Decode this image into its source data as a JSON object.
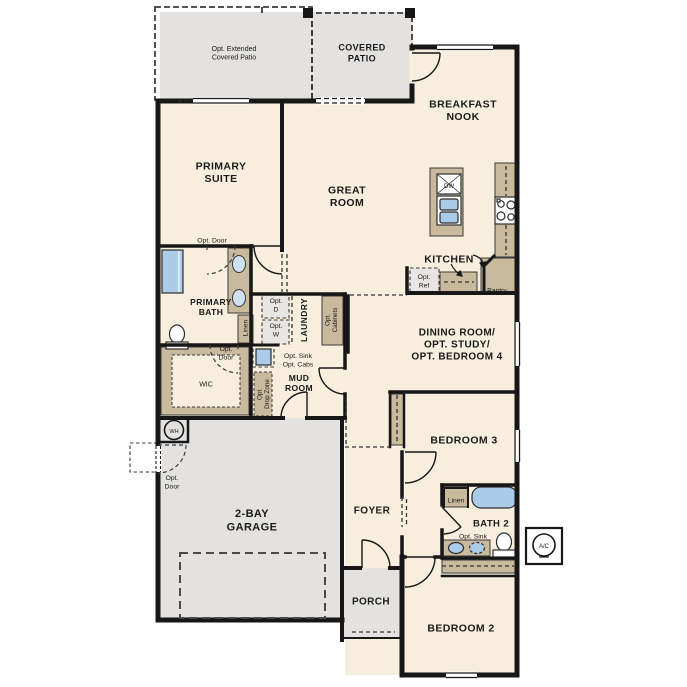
{
  "plan": {
    "name": "single-story-floor-plan",
    "colors": {
      "floor": "#f7eedd",
      "exterior_gray": "#e3e2e0",
      "cabinet_tan": "#c9b99d",
      "option_box_gray": "#e7e6e4",
      "fixture_blue": "#abcbe9",
      "fixture_blue_light": "#cfe0f2",
      "wall_black": "#171717",
      "page_bg": "#ffffff"
    },
    "rooms": [
      "Opt. Extended Covered Patio",
      "Covered Patio",
      "Breakfast Nook",
      "Primary Suite",
      "Great Room",
      "Kitchen",
      "Primary Bath",
      "WIC",
      "Laundry",
      "Mud Room",
      "Dining Room / Opt. Study / Opt. Bedroom 4",
      "Bedroom 3",
      "Bath 2",
      "2-Bay Garage",
      "Foyer",
      "Porch",
      "Bedroom 2"
    ],
    "fixtures": [
      "shower",
      "double-vanity",
      "toilet",
      "linen-cabinet",
      "washer",
      "dryer",
      "laundry-sink",
      "kitchen-island",
      "dishwasher",
      "kitchen-sink",
      "cooktop",
      "refrigerator",
      "pantry",
      "bathtub",
      "vanity-sink",
      "optional-sink",
      "water-heater",
      "ac-unit",
      "closet-rod",
      "garage-door"
    ]
  },
  "labels": [
    {
      "name": "label-opt-extended-covered-patio",
      "lines": [
        "Opt. Extended",
        "Covered Patio"
      ],
      "x": 234,
      "y": 53,
      "size": 7,
      "bold": false,
      "rot": 0
    },
    {
      "name": "label-covered-patio",
      "lines": [
        "COVERED",
        "PATIO"
      ],
      "x": 362,
      "y": 53,
      "size": 9,
      "bold": true,
      "rot": 0
    },
    {
      "name": "label-breakfast-nook",
      "lines": [
        "BREAKFAST",
        "NOOK"
      ],
      "x": 463,
      "y": 110,
      "size": 10.5,
      "bold": true,
      "rot": 0
    },
    {
      "name": "label-primary-suite",
      "lines": [
        "PRIMARY",
        "SUITE"
      ],
      "x": 221,
      "y": 172,
      "size": 10.5,
      "bold": true,
      "rot": 0
    },
    {
      "name": "label-great-room",
      "lines": [
        "GREAT",
        "ROOM"
      ],
      "x": 347,
      "y": 196,
      "size": 10.5,
      "bold": true,
      "rot": 0
    },
    {
      "name": "label-kitchen",
      "lines": [
        "KITCHEN"
      ],
      "x": 449,
      "y": 259,
      "size": 10.5,
      "bold": true,
      "rot": 0
    },
    {
      "name": "label-opt-door-suite",
      "lines": [
        "Opt. Door"
      ],
      "x": 212,
      "y": 240,
      "size": 6.8,
      "bold": false,
      "rot": 0
    },
    {
      "name": "label-primary-bath",
      "lines": [
        "PRIMARY",
        "BATH"
      ],
      "x": 211,
      "y": 307,
      "size": 8.5,
      "bold": true,
      "rot": 0
    },
    {
      "name": "label-linen-primary",
      "lines": [
        "Linen"
      ],
      "x": 245,
      "y": 328,
      "size": 6.8,
      "bold": false,
      "rot": -90
    },
    {
      "name": "label-opt-door-bath",
      "lines": [
        "Opt.",
        "Door"
      ],
      "x": 226,
      "y": 353,
      "size": 6.8,
      "bold": false,
      "rot": 0
    },
    {
      "name": "label-wic",
      "lines": [
        "WIC"
      ],
      "x": 206,
      "y": 384,
      "size": 7,
      "bold": false,
      "rot": 0
    },
    {
      "name": "label-opt-dryer",
      "lines": [
        "Opt.",
        "D"
      ],
      "x": 276,
      "y": 305,
      "size": 6.8,
      "bold": false,
      "rot": 0
    },
    {
      "name": "label-opt-washer",
      "lines": [
        "Opt.",
        "W"
      ],
      "x": 276,
      "y": 330,
      "size": 6.8,
      "bold": false,
      "rot": 0
    },
    {
      "name": "label-laundry",
      "lines": [
        "LAUNDRY"
      ],
      "x": 304,
      "y": 320,
      "size": 8.5,
      "bold": true,
      "rot": -90
    },
    {
      "name": "label-opt-cabinets",
      "lines": [
        "Opt.",
        "Cabinets"
      ],
      "x": 331,
      "y": 320,
      "size": 6.3,
      "bold": false,
      "rot": -90
    },
    {
      "name": "label-opt-sink-cabs",
      "lines": [
        "Opt. Sink",
        "Opt. Cabs"
      ],
      "x": 298,
      "y": 360,
      "size": 6.8,
      "bold": false,
      "rot": 0
    },
    {
      "name": "label-mud-room",
      "lines": [
        "MUD",
        "ROOM"
      ],
      "x": 299,
      "y": 383,
      "size": 8.5,
      "bold": true,
      "rot": 0
    },
    {
      "name": "label-opt-drop-zone",
      "lines": [
        "Opt.",
        "Drop Zone"
      ],
      "x": 263,
      "y": 394,
      "size": 6.3,
      "bold": false,
      "rot": -90
    },
    {
      "name": "label-opt-ref",
      "lines": [
        "Opt.",
        "Ref"
      ],
      "x": 424,
      "y": 281,
      "size": 6.8,
      "bold": false,
      "rot": 0
    },
    {
      "name": "label-pantry",
      "lines": [
        "Pantry"
      ],
      "x": 497,
      "y": 290,
      "size": 6.8,
      "bold": false,
      "rot": 0
    },
    {
      "name": "label-dining-room",
      "lines": [
        "DINING ROOM/",
        "OPT. STUDY/",
        "OPT. BEDROOM 4"
      ],
      "x": 457,
      "y": 344,
      "size": 10,
      "bold": true,
      "rot": 0
    },
    {
      "name": "label-bedroom-3",
      "lines": [
        "BEDROOM 3"
      ],
      "x": 464,
      "y": 440,
      "size": 10.5,
      "bold": true,
      "rot": 0
    },
    {
      "name": "label-linen-bath2",
      "lines": [
        "Linen"
      ],
      "x": 456,
      "y": 500,
      "size": 6.8,
      "bold": false,
      "rot": 0
    },
    {
      "name": "label-bath-2",
      "lines": [
        "BATH 2"
      ],
      "x": 491,
      "y": 523,
      "size": 9.5,
      "bold": true,
      "rot": 0
    },
    {
      "name": "label-opt-sink-bath2",
      "lines": [
        "Opt. Sink"
      ],
      "x": 473,
      "y": 536,
      "size": 6.8,
      "bold": false,
      "rot": 0
    },
    {
      "name": "label-water-heater",
      "lines": [
        "WH"
      ],
      "x": 174,
      "y": 431,
      "size": 5.5,
      "bold": false,
      "rot": 0
    },
    {
      "name": "label-opt-door-garage",
      "lines": [
        "Opt.",
        "Door"
      ],
      "x": 172,
      "y": 482,
      "size": 6.8,
      "bold": false,
      "rot": 0
    },
    {
      "name": "label-garage",
      "lines": [
        "2-BAY",
        "GARAGE"
      ],
      "x": 252,
      "y": 520,
      "size": 11,
      "bold": true,
      "rot": 0
    },
    {
      "name": "label-foyer",
      "lines": [
        "FOYER"
      ],
      "x": 372,
      "y": 510,
      "size": 10,
      "bold": true,
      "rot": 0
    },
    {
      "name": "label-porch",
      "lines": [
        "PORCH"
      ],
      "x": 371,
      "y": 601,
      "size": 10,
      "bold": true,
      "rot": 0
    },
    {
      "name": "label-bedroom-2",
      "lines": [
        "BEDROOM 2"
      ],
      "x": 461,
      "y": 628,
      "size": 10.5,
      "bold": true,
      "rot": 0
    },
    {
      "name": "label-ac-unit",
      "lines": [
        "A/C"
      ],
      "x": 544,
      "y": 546,
      "size": 6,
      "bold": false,
      "rot": 0
    },
    {
      "name": "label-dishwasher",
      "lines": [
        "DW"
      ],
      "x": 449,
      "y": 186,
      "size": 6,
      "bold": false,
      "rot": 0
    }
  ]
}
